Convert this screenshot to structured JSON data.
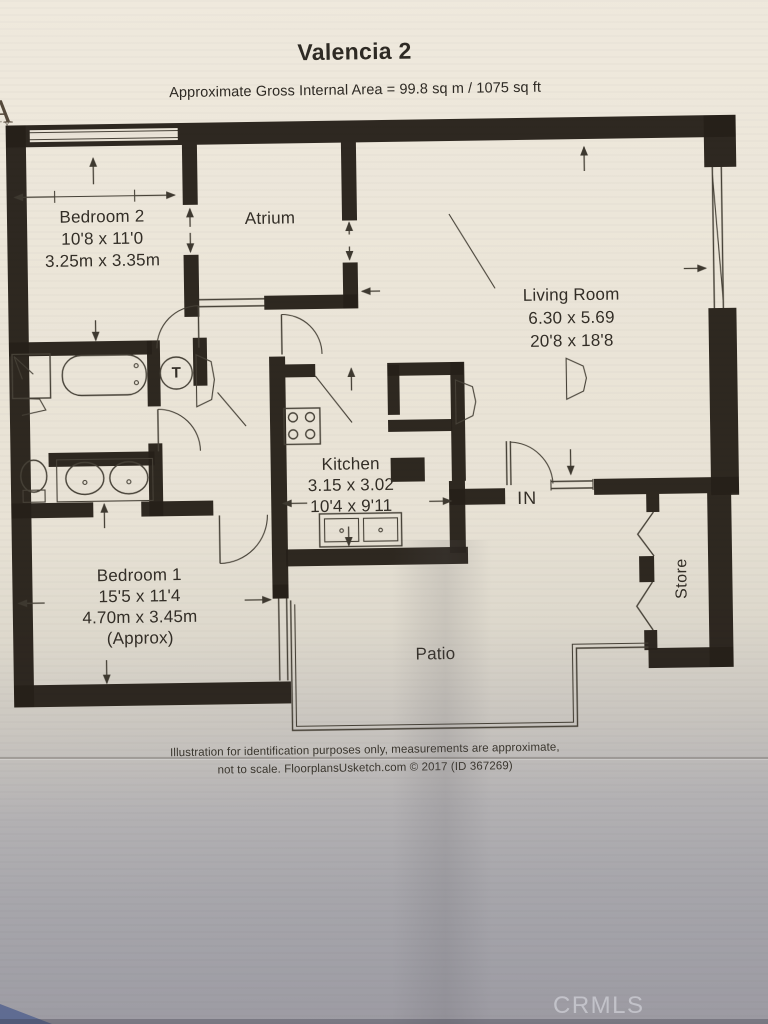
{
  "header": {
    "title": "Valencia 2",
    "subtitle": "Approximate Gross Internal Area = 99.8 sq m / 1075 sq ft"
  },
  "corner_logo": {
    "letter": "A",
    "sub": "TY"
  },
  "rooms": {
    "bedroom2": {
      "name": "Bedroom 2",
      "dims_imperial": "10'8 x 11'0",
      "dims_metric": "3.25m x 3.35m"
    },
    "atrium": {
      "name": "Atrium"
    },
    "living_room": {
      "name": "Living Room",
      "dims_metric": "6.30 x 5.69",
      "dims_imperial": "20'8 x 18'8"
    },
    "kitchen": {
      "name": "Kitchen",
      "dims_metric": "3.15 x 3.02",
      "dims_imperial": "10'4 x 9'11"
    },
    "bedroom1": {
      "name": "Bedroom 1",
      "dims_imperial": "15'5 x 11'4",
      "dims_metric": "4.70m x 3.45m",
      "approx_note": "(Approx)"
    },
    "patio": {
      "name": "Patio"
    },
    "store": {
      "name": "Store"
    }
  },
  "plan_labels": {
    "entrance": "IN",
    "tank": "T"
  },
  "footer": {
    "line1": "Illustration for identification purposes only, measurements are approximate,",
    "line2": "not to scale. FloorplansUsketch.com © 2017 (ID 367269)"
  },
  "watermark": "CRMLS",
  "colors": {
    "wall": "#262019",
    "line": "#464137",
    "text": "#2e2a24",
    "paper": "#eae4d7",
    "watermark": "#c9c9d0"
  }
}
